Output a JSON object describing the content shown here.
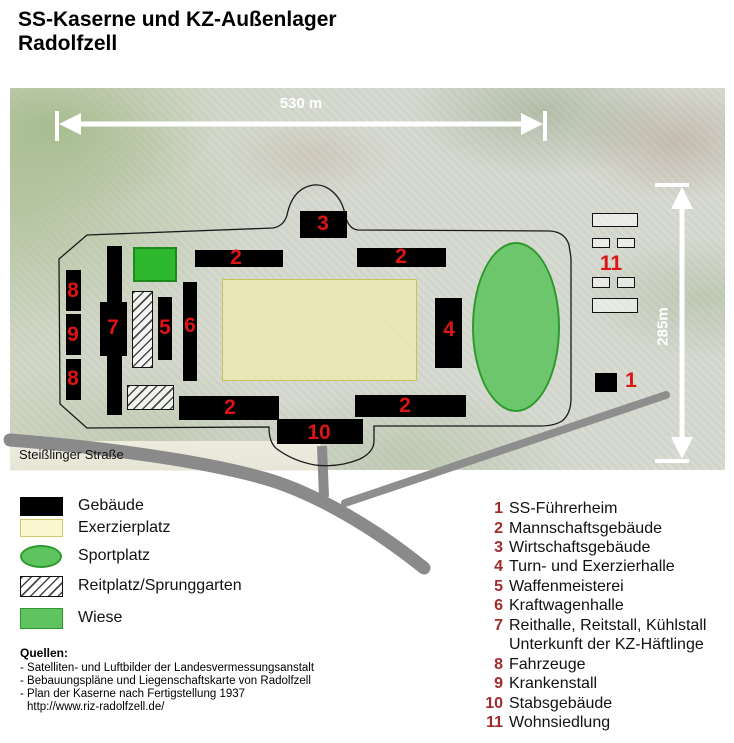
{
  "title": {
    "line1": "SS-Kaserne und KZ-Außenlager",
    "line2": "Radolfzell"
  },
  "map": {
    "scale_horizontal": "530 m",
    "scale_vertical": "285m",
    "street_label": "Steißlinger Straße",
    "labels": [
      "8",
      "9",
      "8",
      "7",
      "5",
      "6",
      "2",
      "2",
      "3",
      "2",
      "2",
      "10",
      "4",
      "1",
      "11"
    ]
  },
  "legend": {
    "items": [
      {
        "label": "Gebäude",
        "swatch": "building-black"
      },
      {
        "label": "Exerzierplatz",
        "swatch": "pale-yellow"
      },
      {
        "label": "Sportplatz",
        "swatch": "green-ellipse"
      },
      {
        "label": "Reitplatz/Sprunggarten",
        "swatch": "hatched"
      },
      {
        "label": "Wiese",
        "swatch": "green-rect"
      }
    ]
  },
  "key": {
    "items": [
      {
        "n": "1",
        "label": "SS-Führerheim"
      },
      {
        "n": "2",
        "label": "Mannschaftsgebäude"
      },
      {
        "n": "3",
        "label": "Wirtschaftsgebäude"
      },
      {
        "n": "4",
        "label": "Turn- und Exerzierhalle"
      },
      {
        "n": "5",
        "label": "Waffenmeisterei"
      },
      {
        "n": "6",
        "label": "Kraftwagenhalle"
      },
      {
        "n": "7",
        "label": "Reithalle, Reitstall, Kühlstall",
        "label2": "Unterkunft der KZ-Häftlinge"
      },
      {
        "n": "8",
        "label": "Fahrzeuge"
      },
      {
        "n": "9",
        "label": "Krankenstall"
      },
      {
        "n": "10",
        "label": "Stabsgebäude"
      },
      {
        "n": "11",
        "label": "Wohnsiedlung"
      }
    ]
  },
  "sources": {
    "heading": "Quellen:",
    "lines": [
      "- Satelliten- und Luftbilder der Landesvermessungsanstalt",
      "- Bebauungspläne und Liegenschaftskarte von Radolfzell",
      "- Plan der Kaserne nach Fertigstellung 1937",
      "http://www.riz-radolfzell.de/"
    ]
  },
  "colors": {
    "map_number_red": "#dc1414",
    "key_number_red": "#a02c2c",
    "road_gray": "#8a8a8a",
    "building_black": "#000000",
    "wiese_green": "#2eb82e",
    "sport_green": "#5fc45f",
    "exerzier_yellow": "#f2eeaa"
  }
}
